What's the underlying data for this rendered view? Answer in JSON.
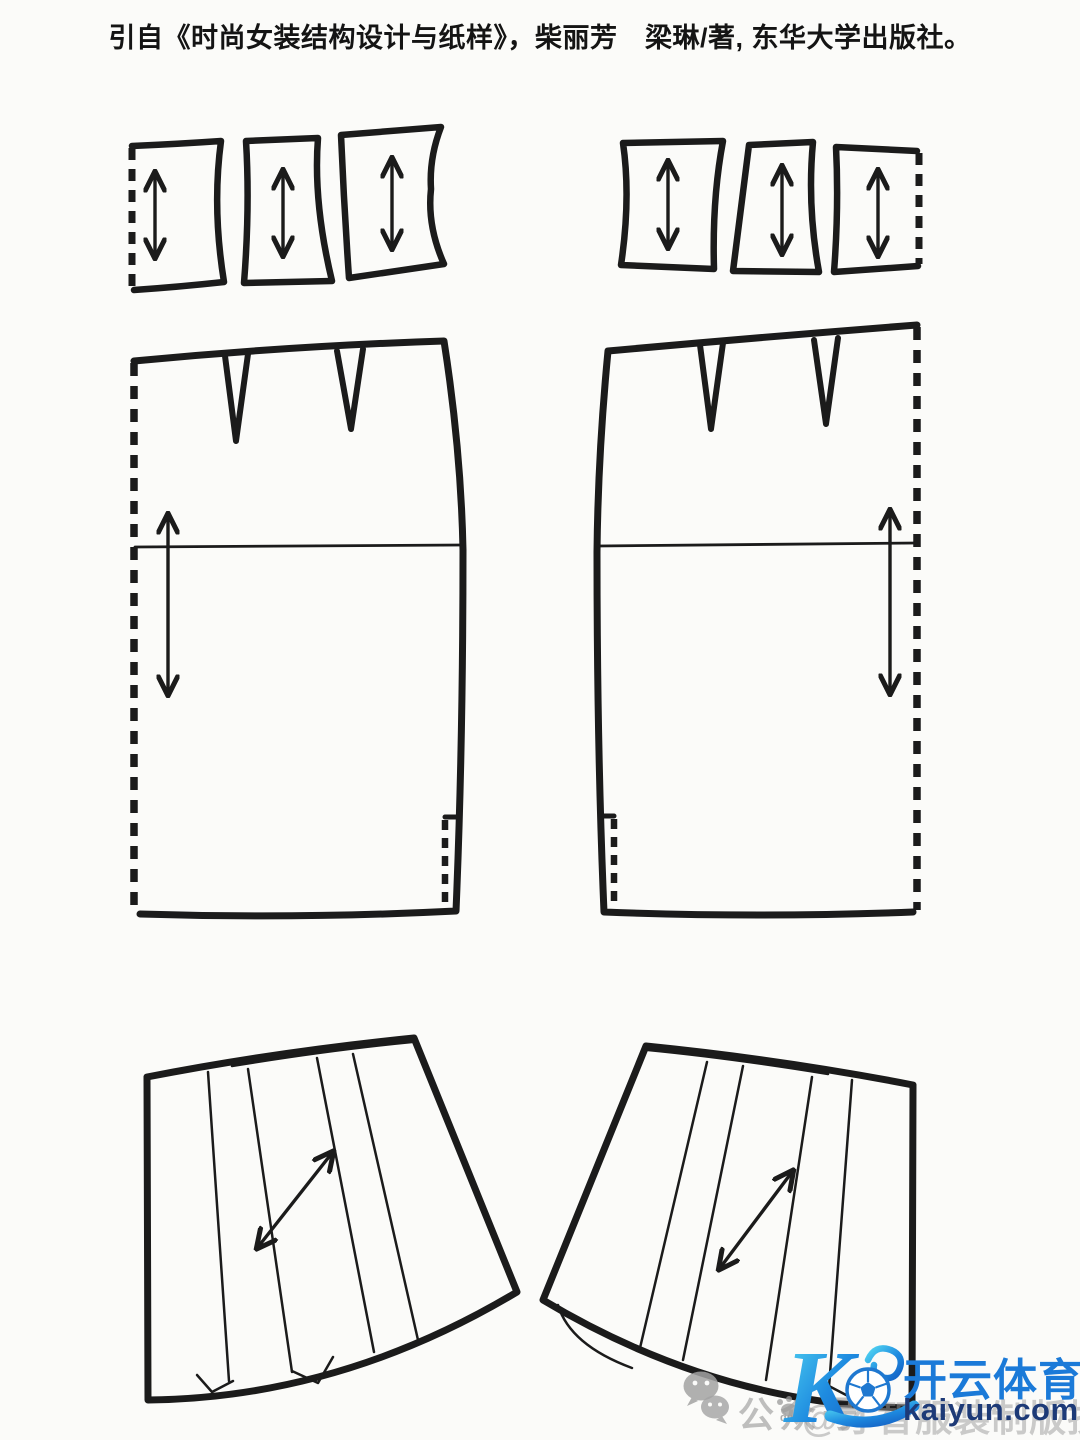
{
  "header": {
    "credit": "引自《时尚女装结构设计与纸样》，柴丽芳　梁琳/著, 东华大学出版社。"
  },
  "watermark": {
    "social_label": "公众号",
    "paw_label": "du",
    "account_text": "@才智服装制版技术",
    "brand_name": "开云体育",
    "brand_domain": "kaiyun.com",
    "colors": {
      "logo_cyan": "#52d6f2",
      "logo_blue": "#1461c4",
      "brand_blue": "#1b7ad8",
      "domain_navy": "#1d3a77",
      "watermark_gray": "#9a9a9a"
    }
  },
  "diagram": {
    "line_color": "#1b1b1b",
    "paper_color": "#fbfbf9",
    "icons": {
      "grain_line_arrow": "↕",
      "bias_grain_arrow": "⤢",
      "wechat_icon": "💬",
      "paw_icon": "🐾",
      "football_icon": "⚽",
      "kaiyun_logo": "K"
    }
  }
}
